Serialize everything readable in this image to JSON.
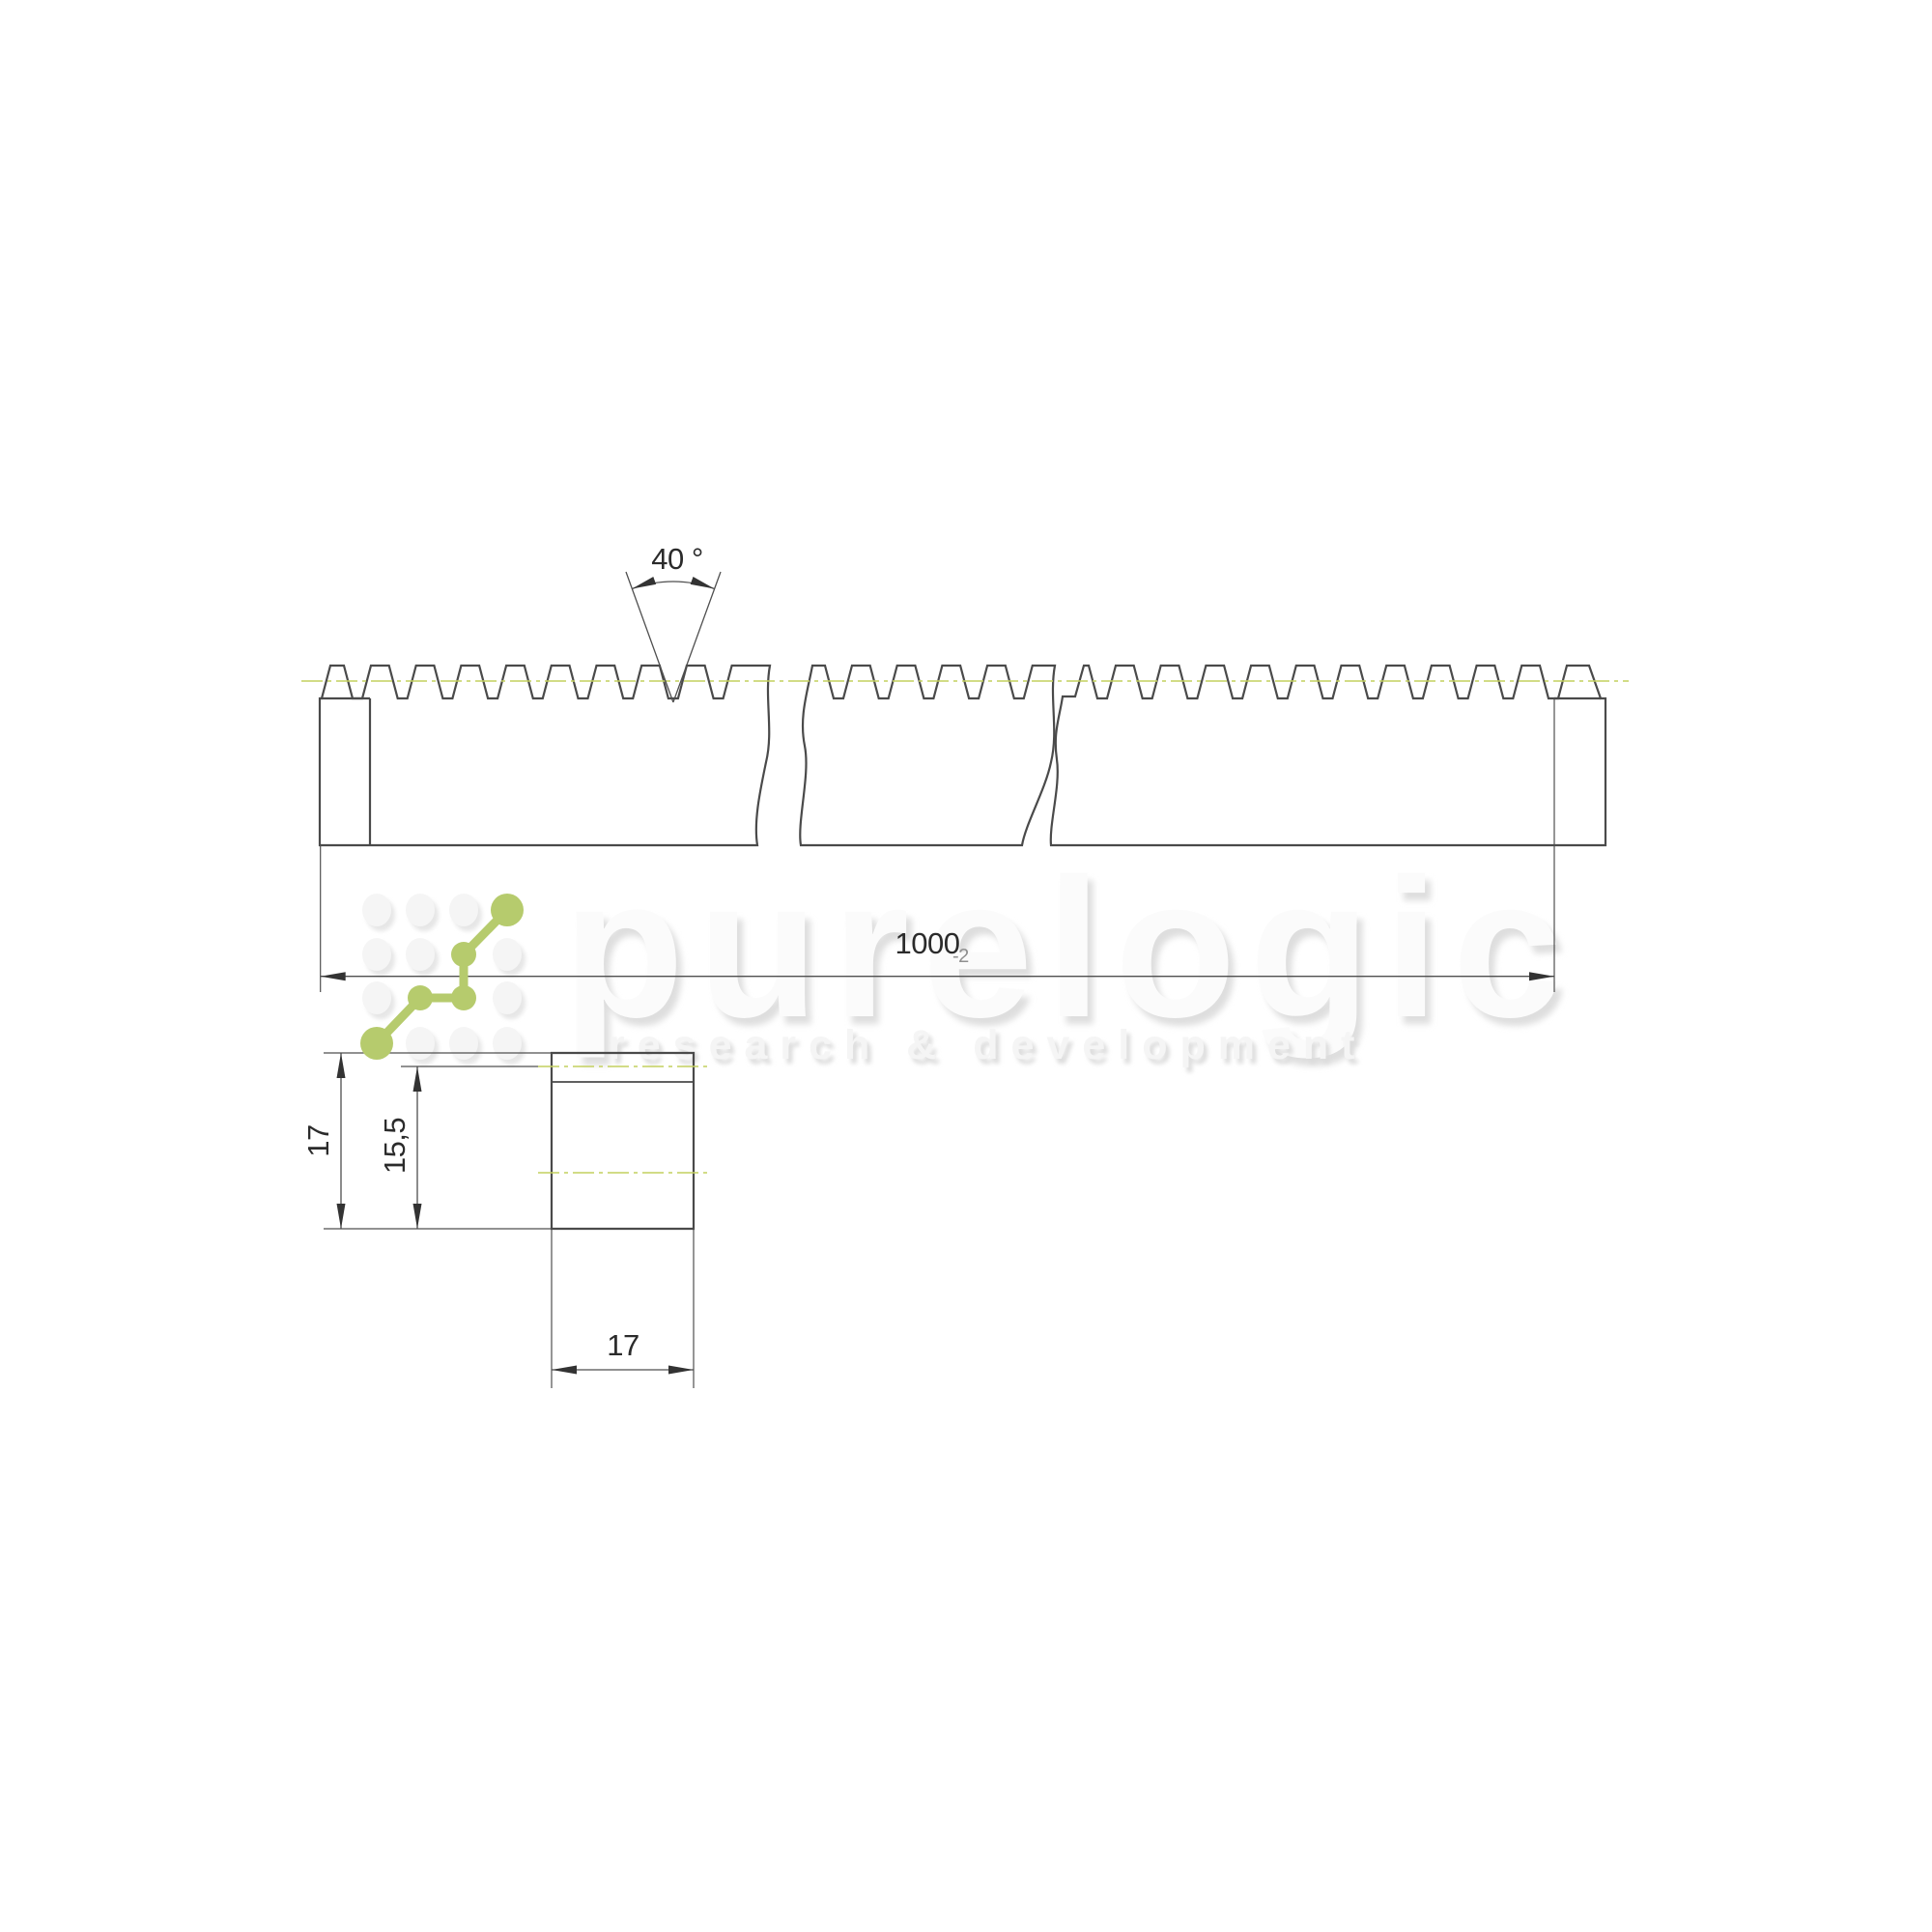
{
  "document": {
    "type": "technical-drawing",
    "subject": "gear rack, side view with breaks and cross-section view"
  },
  "watermark": {
    "brand": "purelogic",
    "tagline": "research & development"
  },
  "dimensions": {
    "tooth_angle": {
      "label": "40 °"
    },
    "length": {
      "value": "1000",
      "tolerance": "-2"
    },
    "section_height": {
      "value": "17"
    },
    "section_pitch_height": {
      "value": "15,5"
    },
    "section_width": {
      "value": "17"
    }
  },
  "colors": {
    "outline": "#4a4a4a",
    "thin_line": "#4f4f4f",
    "dimension_text": "#2b2b2b",
    "tolerance_text": "#8f8f8f",
    "pitch_centerline_green": "#c3d05e",
    "logo_green": "#b6cb6d",
    "watermark_white": "#fbfbfb",
    "watermark_shadow": "#dedede",
    "background": "#ffffff"
  }
}
